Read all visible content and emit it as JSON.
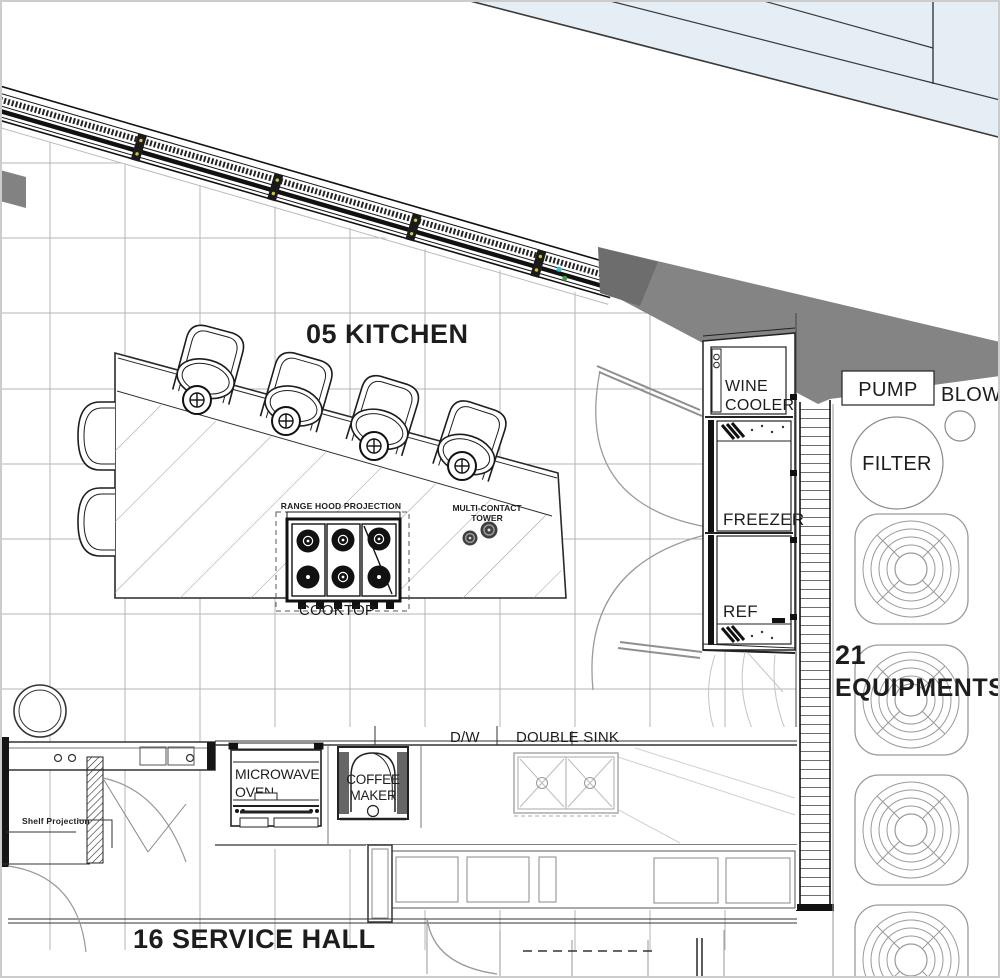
{
  "colors": {
    "glass_blue": "#e4eef4",
    "wall_gray": "#848484",
    "grid_gray": "#b5b5b5",
    "ink": "#1d1d1d",
    "swing_arc": "#9b9b9b"
  },
  "rooms": {
    "kitchen_title": "05 KITCHEN",
    "service_hall_title": "16 SERVICE HALL"
  },
  "island": {
    "cooktop_label": "COOKTOP",
    "range_hood_label": "RANGE HOOD PROJECTION",
    "multi_contact_line1": "MULTI-CONTACT",
    "multi_contact_line2": "TOWER"
  },
  "tall_units": {
    "wine_cooler_line1": "WINE",
    "wine_cooler_line2": "COOLER",
    "freezer": "FREEZER",
    "refrigerator": "REF"
  },
  "counter": {
    "microwave_line1": "MICROWAVE",
    "microwave_line2": "OVEN",
    "coffee_line1": "COFFEE",
    "coffee_line2": "MAKER",
    "dishwasher": "D/W",
    "sink": "DOUBLE SINK"
  },
  "equipment_zone": {
    "count": "21",
    "label": "EQUIPMENTS",
    "pump": "PUMP",
    "blower": "BLOW",
    "filter": "FILTER"
  },
  "annotations": {
    "shelf_projection": "Shelf Projection"
  }
}
